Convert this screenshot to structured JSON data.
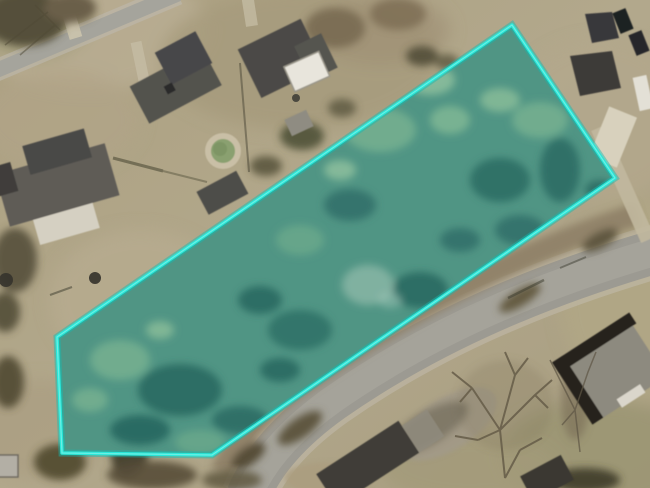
{
  "canvas": {
    "width": "650",
    "height": "488"
  },
  "parcel": {
    "points": "512,25 615,178 212,455 62,453 57,337",
    "vertices": [
      [
        512,
        25
      ],
      [
        615,
        178
      ],
      [
        212,
        455
      ],
      [
        62,
        453
      ],
      [
        57,
        337
      ]
    ],
    "stroke_color": "#27e7d9",
    "glow_color": "#0fbdb4",
    "highlight_color": "#9df5ea",
    "base_fill": "#578a79",
    "tint_color": "#2ae0d4"
  },
  "palette": {
    "ground_tan": "#ac9f82",
    "ground_light": "#bcb198",
    "grass_olive": "#9b9673",
    "road_gray": "#9c9a92",
    "road_shoulder": "#c0bab0",
    "roof_dark": "#4b4a46",
    "roof_gray": "#8d8a7f",
    "tree_dark_olive": "#55503a",
    "parcel_tree_dark": "#2e5d55",
    "parcel_tree_light": "#7ba585",
    "boundary_cyan": "#27e7d9"
  }
}
